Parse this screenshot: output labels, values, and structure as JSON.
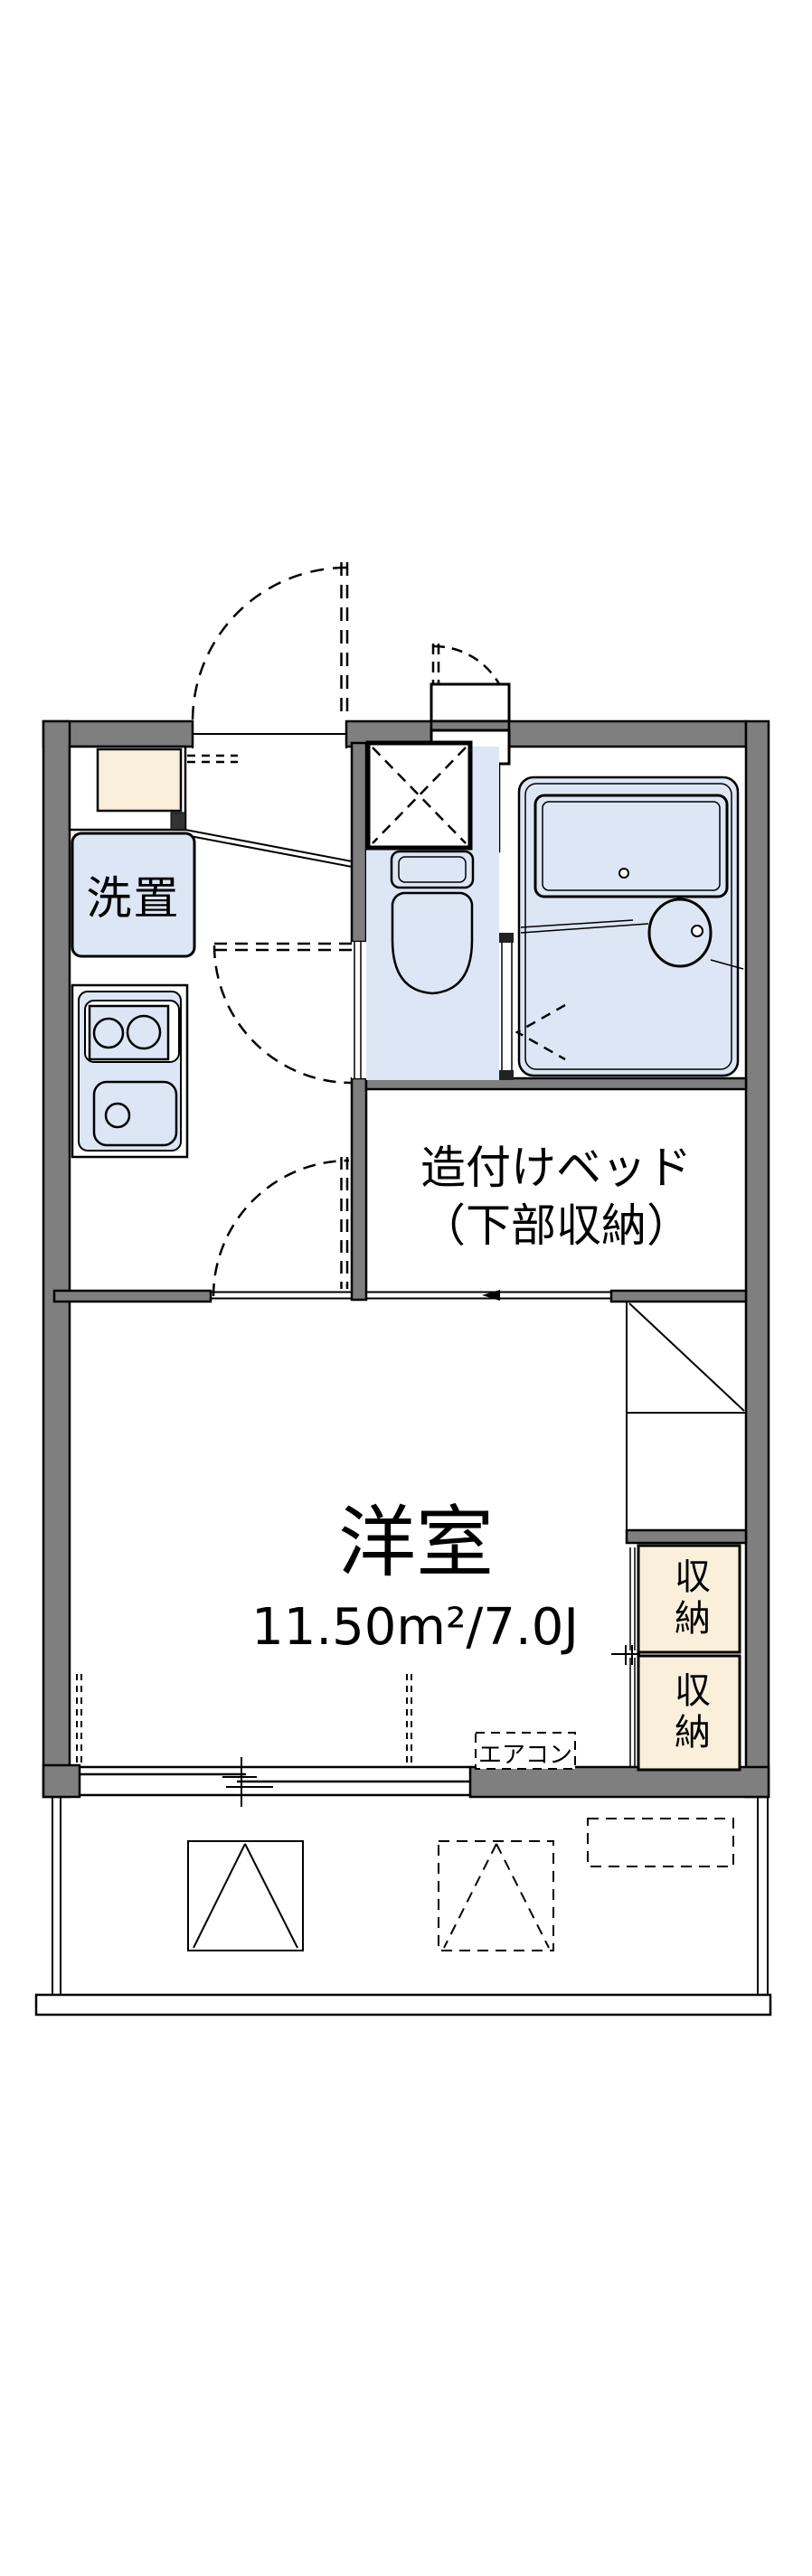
{
  "floor_plan": {
    "labels": {
      "washer": "洗置",
      "bed_line1": "造付けベッド",
      "bed_line2": "（下部収納）",
      "room_name": "洋室",
      "room_size": "11.50m²/7.0J",
      "aircon": "エアコン",
      "closet_upper": "収納",
      "closet_lower": "収納"
    },
    "rooms": [
      {
        "name": "洋室",
        "area_m2": "11.50",
        "area_jo": "7.0"
      }
    ],
    "colors": {
      "wall": "#7f7f7f",
      "water_area": "#dce6f5",
      "closet_fill": "#f9efdb",
      "line": "#000000",
      "background": "#ffffff"
    }
  }
}
